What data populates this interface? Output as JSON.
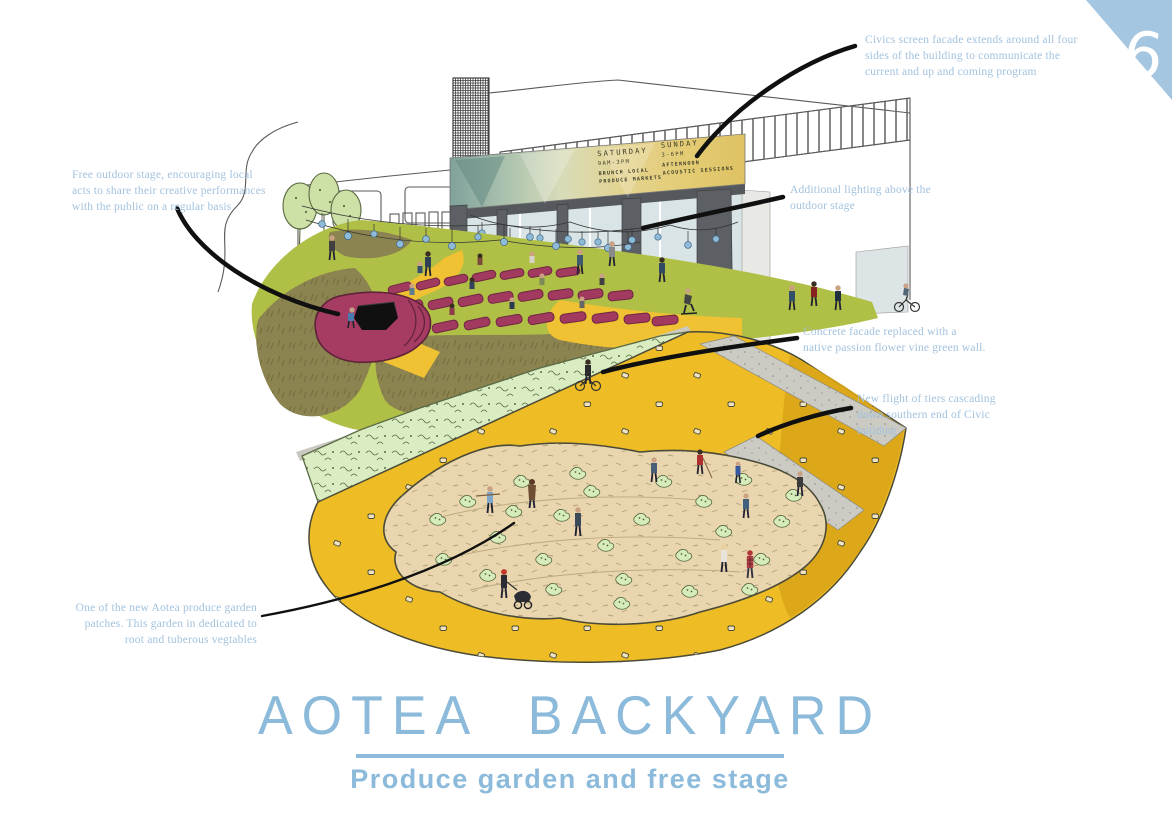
{
  "page": {
    "number": "6"
  },
  "title": {
    "main": "AOTEA BACKYARD",
    "subtitle": "Produce garden and free stage"
  },
  "annotations": {
    "screen_facade": {
      "lines": [
        "Civics screen facade extends around all four",
        "sides of the building to communicate the",
        "current and up and coming program"
      ]
    },
    "outdoor_stage": {
      "lines": [
        "Free outdoor stage, encouraging local",
        "acts to share their creative performances",
        "with the public on a regular basis"
      ]
    },
    "lighting": {
      "lines": [
        "Additional lighting above the",
        "outdoor stage"
      ]
    },
    "green_wall": {
      "lines": [
        "Concrete facade replaced with a",
        "native passion flower vine green wall."
      ]
    },
    "tiers": {
      "lines": [
        "New flight of tiers cascading",
        "down southern end of Civic",
        "building"
      ]
    },
    "garden_patch": {
      "lines": [
        "One of the new Aotea  produce garden",
        "patches. This garden in dedicated to",
        "root and tuberous vegtables"
      ]
    }
  },
  "billboard": {
    "saturday": {
      "day": "SATURDAY",
      "time": "9AM-3PM",
      "line1": "BRUNCH LOCAL",
      "line2": "PRODUCE MARKETS"
    },
    "sunday": {
      "day": "SUNDAY",
      "time": "3-6PM",
      "line1": "AFTERNOON",
      "line2": "ACOUSTIC SESSIONS"
    }
  },
  "colors": {
    "accent_blue": "#8cbadb",
    "annotation_blue": "#a3c2de",
    "triangle_blue": "#a5c6e1",
    "lawn_green": "#b0bf45",
    "olive_grass": "#8b8350",
    "path_yellow": "#eebc25",
    "mustard": "#d9a51a",
    "soil_beige": "#e9d6ae",
    "sprout_green": "#d6ecba",
    "hedge_green": "#daecc2",
    "stage_magenta": "#a63c64",
    "bulb_blue": "#8ebcd8",
    "concrete": "#ccccc5",
    "column_gray": "#606468"
  }
}
